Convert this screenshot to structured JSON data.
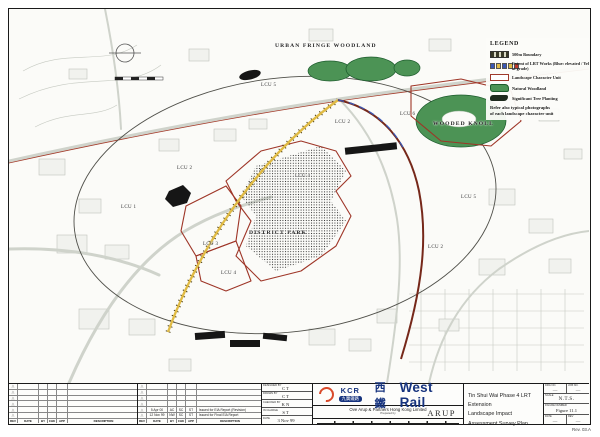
{
  "page": {
    "rev_note": "Rev. 03.A"
  },
  "legend": {
    "title": "LEGEND",
    "items": [
      {
        "symbol": "500m-boundary",
        "label": "500m Boundary"
      },
      {
        "symbol": "lrt-works",
        "label": "Extent of LRT Works (Blue: elevated / Yellow: at grade)"
      },
      {
        "symbol": "landscape-character-unit",
        "label": "Landscape Character Unit"
      },
      {
        "symbol": "natural-woodland",
        "label": "Natural Woodland"
      },
      {
        "symbol": "significant-tree-planting",
        "label": "Significant Tree Planting"
      }
    ],
    "note_line1": "Refer also typical photographs",
    "note_line2": "of each landscape character unit"
  },
  "map": {
    "labels": [
      {
        "text": "URBAN FRINGE WOODLAND"
      },
      {
        "text": "LCU 5"
      },
      {
        "text": "LCU 2"
      },
      {
        "text": "LCU 6"
      },
      {
        "text": "WOODED KNOLL"
      },
      {
        "text": "LCU 2"
      },
      {
        "text": "LCU 4"
      },
      {
        "text": "LCU 1"
      },
      {
        "text": "LCU 5"
      },
      {
        "text": "DISTRICT PARK"
      },
      {
        "text": "LCU 3"
      },
      {
        "text": "LCU 2"
      },
      {
        "text": "LCU 4"
      }
    ]
  },
  "revisions": {
    "headers": [
      "REV",
      "DATE",
      "BY",
      "CHK",
      "APP",
      "DESCRIPTION"
    ],
    "rows": [
      {
        "date": "5 Apr 00",
        "by": "AC",
        "chk": "SC",
        "app": "ST",
        "desc": "Issued for EIA Report (Revision)"
      },
      {
        "date": "12 Nov 99",
        "by": "NW",
        "chk": "SC",
        "app": "ST",
        "desc": "Issued for Final EIA Report"
      }
    ]
  },
  "signatures": {
    "rows": [
      {
        "label": "DESIGNED BY",
        "value": "CT"
      },
      {
        "label": "DRAWN BY",
        "value": "CT"
      },
      {
        "label": "CHECKED BY",
        "value": "KN"
      },
      {
        "label": "IN CHARGE",
        "value": "ST"
      },
      {
        "label": "DATE",
        "value": "3 Nov 99"
      }
    ]
  },
  "branding": {
    "kcr": "KCR",
    "kcr_chinese": "九廣鐵路",
    "westrail_chinese": "西鐵",
    "westrail": "West Rail",
    "arup_line": "Ove Arup & Partners Hong Kong Limited",
    "arup_sub": "Prepared by",
    "arup_logo": "ARUP"
  },
  "title_block": {
    "line1": "Tin Shui Wai Phase 4 LRT Extension",
    "line2": "Landscape Impact Assessment Survey Plan",
    "fields": [
      {
        "label": "DRG NO.",
        "value": "—"
      },
      {
        "label": "JOB NO.",
        "value": "—"
      },
      {
        "label": "SCALE",
        "value": "N.T.S."
      },
      {
        "label": "FIGURE NUMBER",
        "value": "Figure 11.1"
      },
      {
        "label": "DATE",
        "value": "—"
      },
      {
        "label": "REV",
        "value": "—"
      }
    ]
  },
  "colors": {
    "lcu_boundary": "#9e3527",
    "woodland_green": "#4c9355",
    "lrt_yellow": "#e0bb45",
    "lrt_blue": "#3a57b4",
    "brand_navy": "#16337e",
    "brand_red": "#d94a2a"
  }
}
